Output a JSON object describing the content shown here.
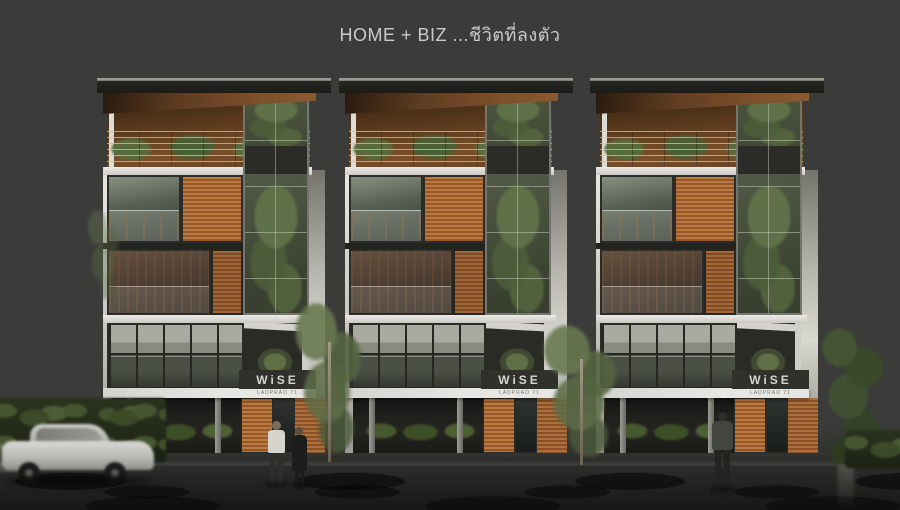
{
  "title": "HOME + BIZ ...ชีวิตที่ลงตัว",
  "buildings": {
    "count": 3,
    "names": [
      "building-left",
      "building-center",
      "building-right"
    ],
    "sign": {
      "brand": "WiSE",
      "sub": "LADPRAO 71"
    }
  },
  "colors": {
    "background": "#3b3b39",
    "slab_white": "#e4e4e0",
    "wood_cladding": "#b06f35",
    "glass": "#454c40",
    "foliage": "#55653f",
    "street": "#232320",
    "curb": "#c3b894",
    "title_text": "#cbcbc8",
    "sign_text": "#d6d6d0"
  }
}
